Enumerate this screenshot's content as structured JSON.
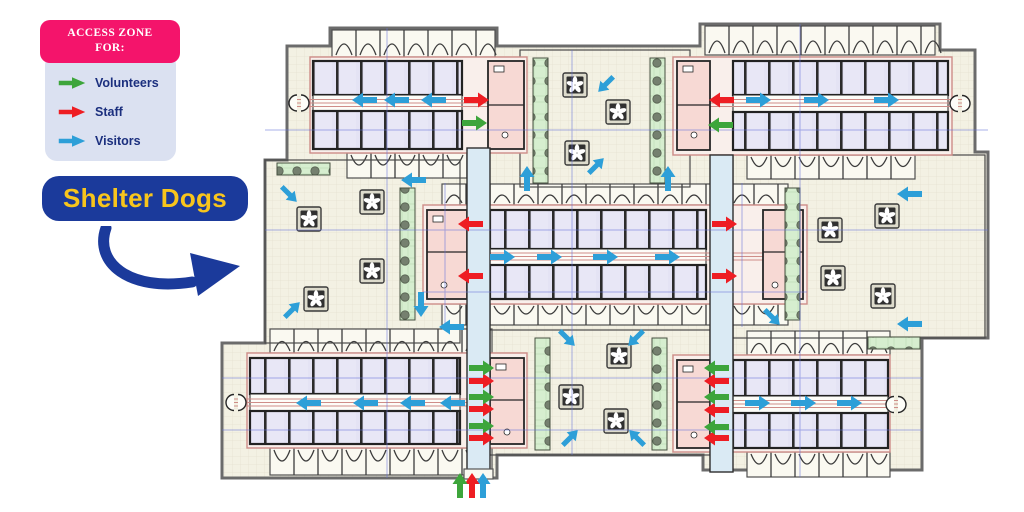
{
  "legend": {
    "title_line1": "ACCESS ZONE",
    "title_line2": "FOR:",
    "header_bg": "#F4146B",
    "body_bg": "#DBE1F1",
    "text_color": "#1B2F7E",
    "items": [
      {
        "id": "volunteers",
        "label": "Volunteers",
        "color": "#3DA53B"
      },
      {
        "id": "staff",
        "label": "Staff",
        "color": "#EE1D23"
      },
      {
        "id": "visitors",
        "label": "Visitors",
        "color": "#2D9FD8"
      }
    ]
  },
  "callout": {
    "label": "Shelter Dogs",
    "bg": "#1B3A9B",
    "text_color": "#F8C51C",
    "arrow_color": "#1B3A9B"
  },
  "floorplan": {
    "access_arrows": [
      {
        "x": 365,
        "y": 100,
        "dir": "left",
        "group": "visitors"
      },
      {
        "x": 397,
        "y": 100,
        "dir": "left",
        "group": "visitors"
      },
      {
        "x": 434,
        "y": 100,
        "dir": "left",
        "group": "visitors"
      },
      {
        "x": 758,
        "y": 100,
        "dir": "right",
        "group": "visitors"
      },
      {
        "x": 816,
        "y": 100,
        "dir": "right",
        "group": "visitors"
      },
      {
        "x": 886,
        "y": 100,
        "dir": "right",
        "group": "visitors"
      },
      {
        "x": 502,
        "y": 257,
        "dir": "right",
        "group": "visitors"
      },
      {
        "x": 549,
        "y": 257,
        "dir": "right",
        "group": "visitors"
      },
      {
        "x": 605,
        "y": 257,
        "dir": "right",
        "group": "visitors"
      },
      {
        "x": 667,
        "y": 257,
        "dir": "right",
        "group": "visitors"
      },
      {
        "x": 309,
        "y": 403,
        "dir": "left",
        "group": "visitors"
      },
      {
        "x": 366,
        "y": 403,
        "dir": "left",
        "group": "visitors"
      },
      {
        "x": 413,
        "y": 403,
        "dir": "left",
        "group": "visitors"
      },
      {
        "x": 453,
        "y": 403,
        "dir": "left",
        "group": "visitors"
      },
      {
        "x": 757,
        "y": 403,
        "dir": "right",
        "group": "visitors"
      },
      {
        "x": 803,
        "y": 403,
        "dir": "right",
        "group": "visitors"
      },
      {
        "x": 849,
        "y": 403,
        "dir": "right",
        "group": "visitors"
      },
      {
        "x": 606,
        "y": 84,
        "dir": "down-left",
        "group": "visitors"
      },
      {
        "x": 596,
        "y": 166,
        "dir": "up-right",
        "group": "visitors"
      },
      {
        "x": 527,
        "y": 179,
        "dir": "up",
        "group": "visitors"
      },
      {
        "x": 668,
        "y": 179,
        "dir": "up",
        "group": "visitors"
      },
      {
        "x": 289,
        "y": 194,
        "dir": "down-right",
        "group": "visitors"
      },
      {
        "x": 292,
        "y": 310,
        "dir": "up-right",
        "group": "visitors"
      },
      {
        "x": 414,
        "y": 180,
        "dir": "left",
        "group": "visitors"
      },
      {
        "x": 421,
        "y": 304,
        "dir": "down",
        "group": "visitors"
      },
      {
        "x": 910,
        "y": 194,
        "dir": "left",
        "group": "visitors"
      },
      {
        "x": 910,
        "y": 324,
        "dir": "left",
        "group": "visitors"
      },
      {
        "x": 567,
        "y": 338,
        "dir": "down-right",
        "group": "visitors"
      },
      {
        "x": 636,
        "y": 338,
        "dir": "down-left",
        "group": "visitors"
      },
      {
        "x": 570,
        "y": 438,
        "dir": "up-right",
        "group": "visitors"
      },
      {
        "x": 637,
        "y": 438,
        "dir": "up-left",
        "group": "visitors"
      },
      {
        "x": 452,
        "y": 327,
        "dir": "left",
        "group": "visitors"
      },
      {
        "x": 772,
        "y": 317,
        "dir": "down-right",
        "group": "visitors"
      },
      {
        "x": 483,
        "y": 486,
        "dir": "up",
        "group": "visitors"
      },
      {
        "x": 476,
        "y": 100,
        "dir": "right",
        "group": "staff"
      },
      {
        "x": 722,
        "y": 100,
        "dir": "left",
        "group": "staff"
      },
      {
        "x": 471,
        "y": 224,
        "dir": "left",
        "group": "staff"
      },
      {
        "x": 471,
        "y": 276,
        "dir": "left",
        "group": "staff"
      },
      {
        "x": 724,
        "y": 224,
        "dir": "right",
        "group": "staff"
      },
      {
        "x": 724,
        "y": 276,
        "dir": "right",
        "group": "staff"
      },
      {
        "x": 481,
        "y": 381,
        "dir": "right",
        "group": "staff"
      },
      {
        "x": 481,
        "y": 409,
        "dir": "right",
        "group": "staff"
      },
      {
        "x": 481,
        "y": 438,
        "dir": "right",
        "group": "staff"
      },
      {
        "x": 717,
        "y": 381,
        "dir": "left",
        "group": "staff"
      },
      {
        "x": 717,
        "y": 410,
        "dir": "left",
        "group": "staff"
      },
      {
        "x": 717,
        "y": 438,
        "dir": "left",
        "group": "staff"
      },
      {
        "x": 472,
        "y": 486,
        "dir": "up",
        "group": "staff"
      },
      {
        "x": 474,
        "y": 123,
        "dir": "right",
        "group": "volunteers"
      },
      {
        "x": 721,
        "y": 125,
        "dir": "left",
        "group": "volunteers"
      },
      {
        "x": 481,
        "y": 368,
        "dir": "right",
        "group": "volunteers"
      },
      {
        "x": 481,
        "y": 397,
        "dir": "right",
        "group": "volunteers"
      },
      {
        "x": 481,
        "y": 426,
        "dir": "right",
        "group": "volunteers"
      },
      {
        "x": 717,
        "y": 368,
        "dir": "left",
        "group": "volunteers"
      },
      {
        "x": 717,
        "y": 397,
        "dir": "left",
        "group": "volunteers"
      },
      {
        "x": 717,
        "y": 427,
        "dir": "left",
        "group": "volunteers"
      },
      {
        "x": 460,
        "y": 486,
        "dir": "up",
        "group": "volunteers"
      }
    ],
    "fans": [
      [
        575,
        85
      ],
      [
        618,
        112
      ],
      [
        577,
        153
      ],
      [
        309,
        219
      ],
      [
        372,
        202
      ],
      [
        372,
        271
      ],
      [
        316,
        299
      ],
      [
        830,
        230
      ],
      [
        887,
        216
      ],
      [
        833,
        278
      ],
      [
        883,
        296
      ],
      [
        571,
        397
      ],
      [
        619,
        356
      ],
      [
        616,
        421
      ]
    ],
    "green_strips": [
      {
        "x": 533,
        "y": 58,
        "w": 15,
        "h": 125
      },
      {
        "x": 650,
        "y": 58,
        "w": 15,
        "h": 125
      },
      {
        "x": 400,
        "y": 188,
        "w": 15,
        "h": 132
      },
      {
        "x": 785,
        "y": 188,
        "w": 15,
        "h": 132
      },
      {
        "x": 277,
        "y": 163,
        "w": 53,
        "h": 12
      },
      {
        "x": 868,
        "y": 337,
        "w": 52,
        "h": 12
      },
      {
        "x": 535,
        "y": 338,
        "w": 15,
        "h": 112
      },
      {
        "x": 652,
        "y": 338,
        "w": 15,
        "h": 112
      }
    ]
  }
}
